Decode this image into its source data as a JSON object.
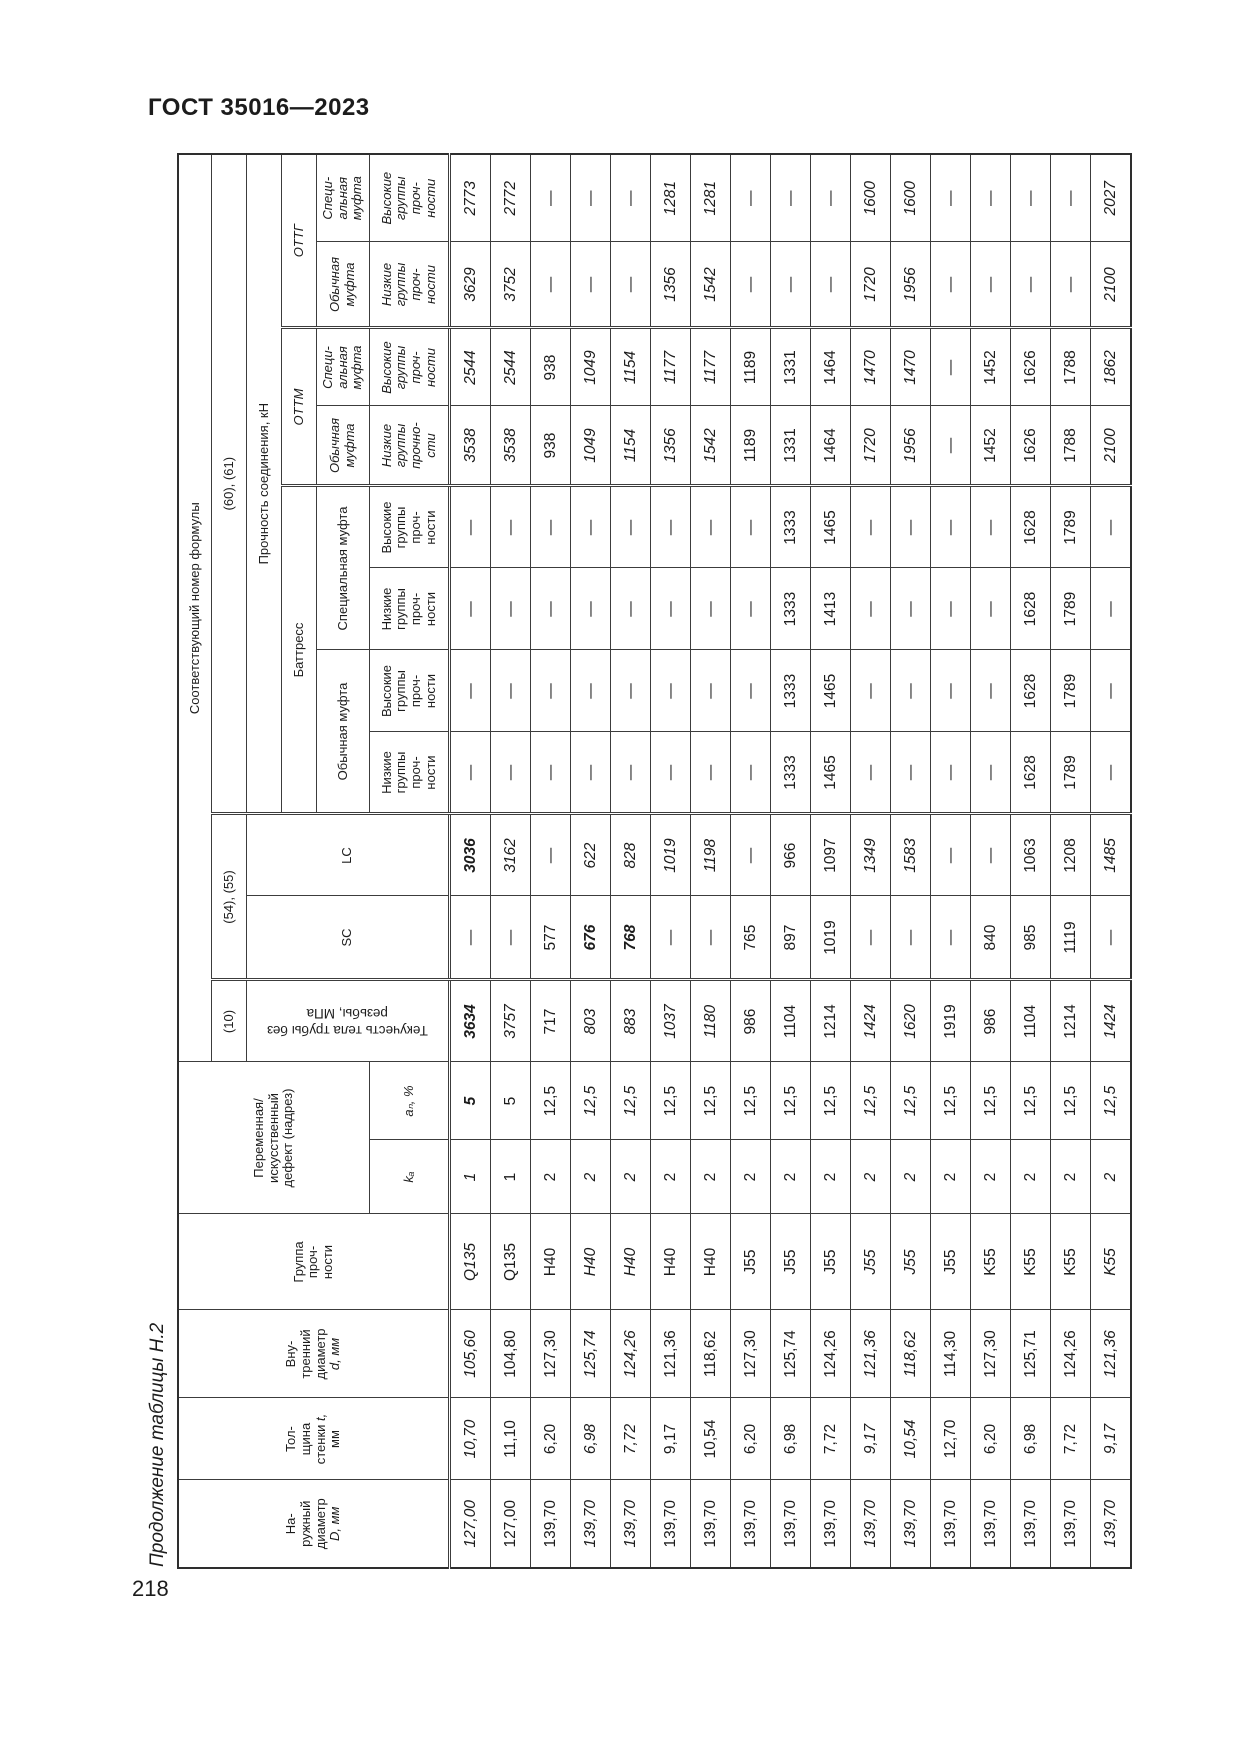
{
  "page": {
    "standard": "ГОСТ 35016—2023",
    "number": "218",
    "caption": "Продолжение таблицы Н.2"
  },
  "table": {
    "headers": {
      "outer_d_1": "На-\nружный\nдиаметр\n",
      "outer_d_sym": "D, мм",
      "wall_1": "Тол-\nщина\nстенки ",
      "wall_sym": "t,",
      "wall_2": "\nмм",
      "inner_d_1": "Вну-\nтренний\nдиаметр\n",
      "inner_d_sym": "d, мм",
      "grade": "Группа\nпроч-\nности",
      "defect": "Переменная/\nискусственный\nдефект (надрез)",
      "ka": "kₐ",
      "an": "aₙ, %",
      "formula_title": "Соответствующий номер формулы",
      "f10": "(10)",
      "f54": "(54), (55)",
      "f60": "(60), (61)",
      "yield_body": "Текучесть тела трубы без\nрезьбы, МПа",
      "sc": "SC",
      "lc": "LC",
      "strength": "Прочность соединения, кН",
      "buttress": "Баттресс",
      "ottm": "ОТТМ",
      "ottg": "ОТТГ",
      "usual_coupling": "Обычная муфта",
      "special_coupling": "Специальная муфта",
      "usual_coupling_2l": "Обычная\nмуфта",
      "special_coupling_3l": "Специ-\nальная\nмуфта",
      "low_groups": "Низкие\nгруппы\nпроч-\nности",
      "high_groups": "Высокие\nгруппы\nпроч-\nности",
      "low_groups_ottm": "Низкие\nгруппы\nпрочно-\nсти"
    },
    "rows": [
      [
        "127,00",
        "10,70",
        "105,60",
        "Q135",
        "1",
        "5",
        "3634",
        "—",
        "3036",
        "—",
        "—",
        "—",
        "—",
        "3538",
        "2544",
        "3629",
        "2773"
      ],
      [
        "127,00",
        "11,10",
        "104,80",
        "Q135",
        "1",
        "5",
        "3757",
        "—",
        "3162",
        "—",
        "—",
        "—",
        "—",
        "3538",
        "2544",
        "3752",
        "2772"
      ],
      [
        "139,70",
        "6,20",
        "127,30",
        "H40",
        "2",
        "12,5",
        "717",
        "577",
        "—",
        "—",
        "—",
        "—",
        "—",
        "938",
        "938",
        "—",
        "—"
      ],
      [
        "139,70",
        "6,98",
        "125,74",
        "H40",
        "2",
        "12,5",
        "803",
        "676",
        "622",
        "—",
        "—",
        "—",
        "—",
        "1049",
        "1049",
        "—",
        "—"
      ],
      [
        "139,70",
        "7,72",
        "124,26",
        "H40",
        "2",
        "12,5",
        "883",
        "768",
        "828",
        "—",
        "—",
        "—",
        "—",
        "1154",
        "1154",
        "—",
        "—"
      ],
      [
        "139,70",
        "9,17",
        "121,36",
        "H40",
        "2",
        "12,5",
        "1037",
        "—",
        "1019",
        "—",
        "—",
        "—",
        "—",
        "1356",
        "1177",
        "1356",
        "1281"
      ],
      [
        "139,70",
        "10,54",
        "118,62",
        "H40",
        "2",
        "12,5",
        "1180",
        "—",
        "1198",
        "—",
        "—",
        "—",
        "—",
        "1542",
        "1177",
        "1542",
        "1281"
      ],
      [
        "139,70",
        "6,20",
        "127,30",
        "J55",
        "2",
        "12,5",
        "986",
        "765",
        "—",
        "—",
        "—",
        "—",
        "—",
        "1189",
        "1189",
        "—",
        "—"
      ],
      [
        "139,70",
        "6,98",
        "125,74",
        "J55",
        "2",
        "12,5",
        "1104",
        "897",
        "966",
        "1333",
        "1333",
        "1333",
        "1333",
        "1331",
        "1331",
        "—",
        "—"
      ],
      [
        "139,70",
        "7,72",
        "124,26",
        "J55",
        "2",
        "12,5",
        "1214",
        "1019",
        "1097",
        "1465",
        "1465",
        "1413",
        "1465",
        "1464",
        "1464",
        "—",
        "—"
      ],
      [
        "139,70",
        "9,17",
        "121,36",
        "J55",
        "2",
        "12,5",
        "1424",
        "—",
        "1349",
        "—",
        "—",
        "—",
        "—",
        "1720",
        "1470",
        "1720",
        "1600"
      ],
      [
        "139,70",
        "10,54",
        "118,62",
        "J55",
        "2",
        "12,5",
        "1620",
        "—",
        "1583",
        "—",
        "—",
        "—",
        "—",
        "1956",
        "1470",
        "1956",
        "1600"
      ],
      [
        "139,70",
        "12,70",
        "114,30",
        "J55",
        "2",
        "12,5",
        "1919",
        "—",
        "—",
        "—",
        "—",
        "—",
        "—",
        "—",
        "—",
        "—",
        "—"
      ],
      [
        "139,70",
        "6,20",
        "127,30",
        "K55",
        "2",
        "12,5",
        "986",
        "840",
        "—",
        "—",
        "—",
        "—",
        "—",
        "1452",
        "1452",
        "—",
        "—"
      ],
      [
        "139,70",
        "6,98",
        "125,71",
        "K55",
        "2",
        "12,5",
        "1104",
        "985",
        "1063",
        "1628",
        "1628",
        "1628",
        "1628",
        "1626",
        "1626",
        "—",
        "—"
      ],
      [
        "139,70",
        "7,72",
        "124,26",
        "K55",
        "2",
        "12,5",
        "1214",
        "1119",
        "1208",
        "1789",
        "1789",
        "1789",
        "1789",
        "1788",
        "1788",
        "—",
        "—"
      ],
      [
        "139,70",
        "9,17",
        "121,36",
        "K55",
        "2",
        "12,5",
        "1424",
        "—",
        "1485",
        "—",
        "—",
        "—",
        "—",
        "2100",
        "1862",
        "2100",
        "2027"
      ]
    ],
    "emphasis": {
      "italic_rows_left": [
        1,
        4,
        5,
        11,
        12,
        17
      ],
      "italic_rows_formula": [
        1,
        2,
        4,
        5,
        6,
        7,
        11,
        12,
        17
      ],
      "bold_cells": [
        [
          1,
          6
        ],
        [
          1,
          7
        ],
        [
          1,
          9
        ],
        [
          4,
          8
        ],
        [
          5,
          8
        ]
      ]
    }
  }
}
